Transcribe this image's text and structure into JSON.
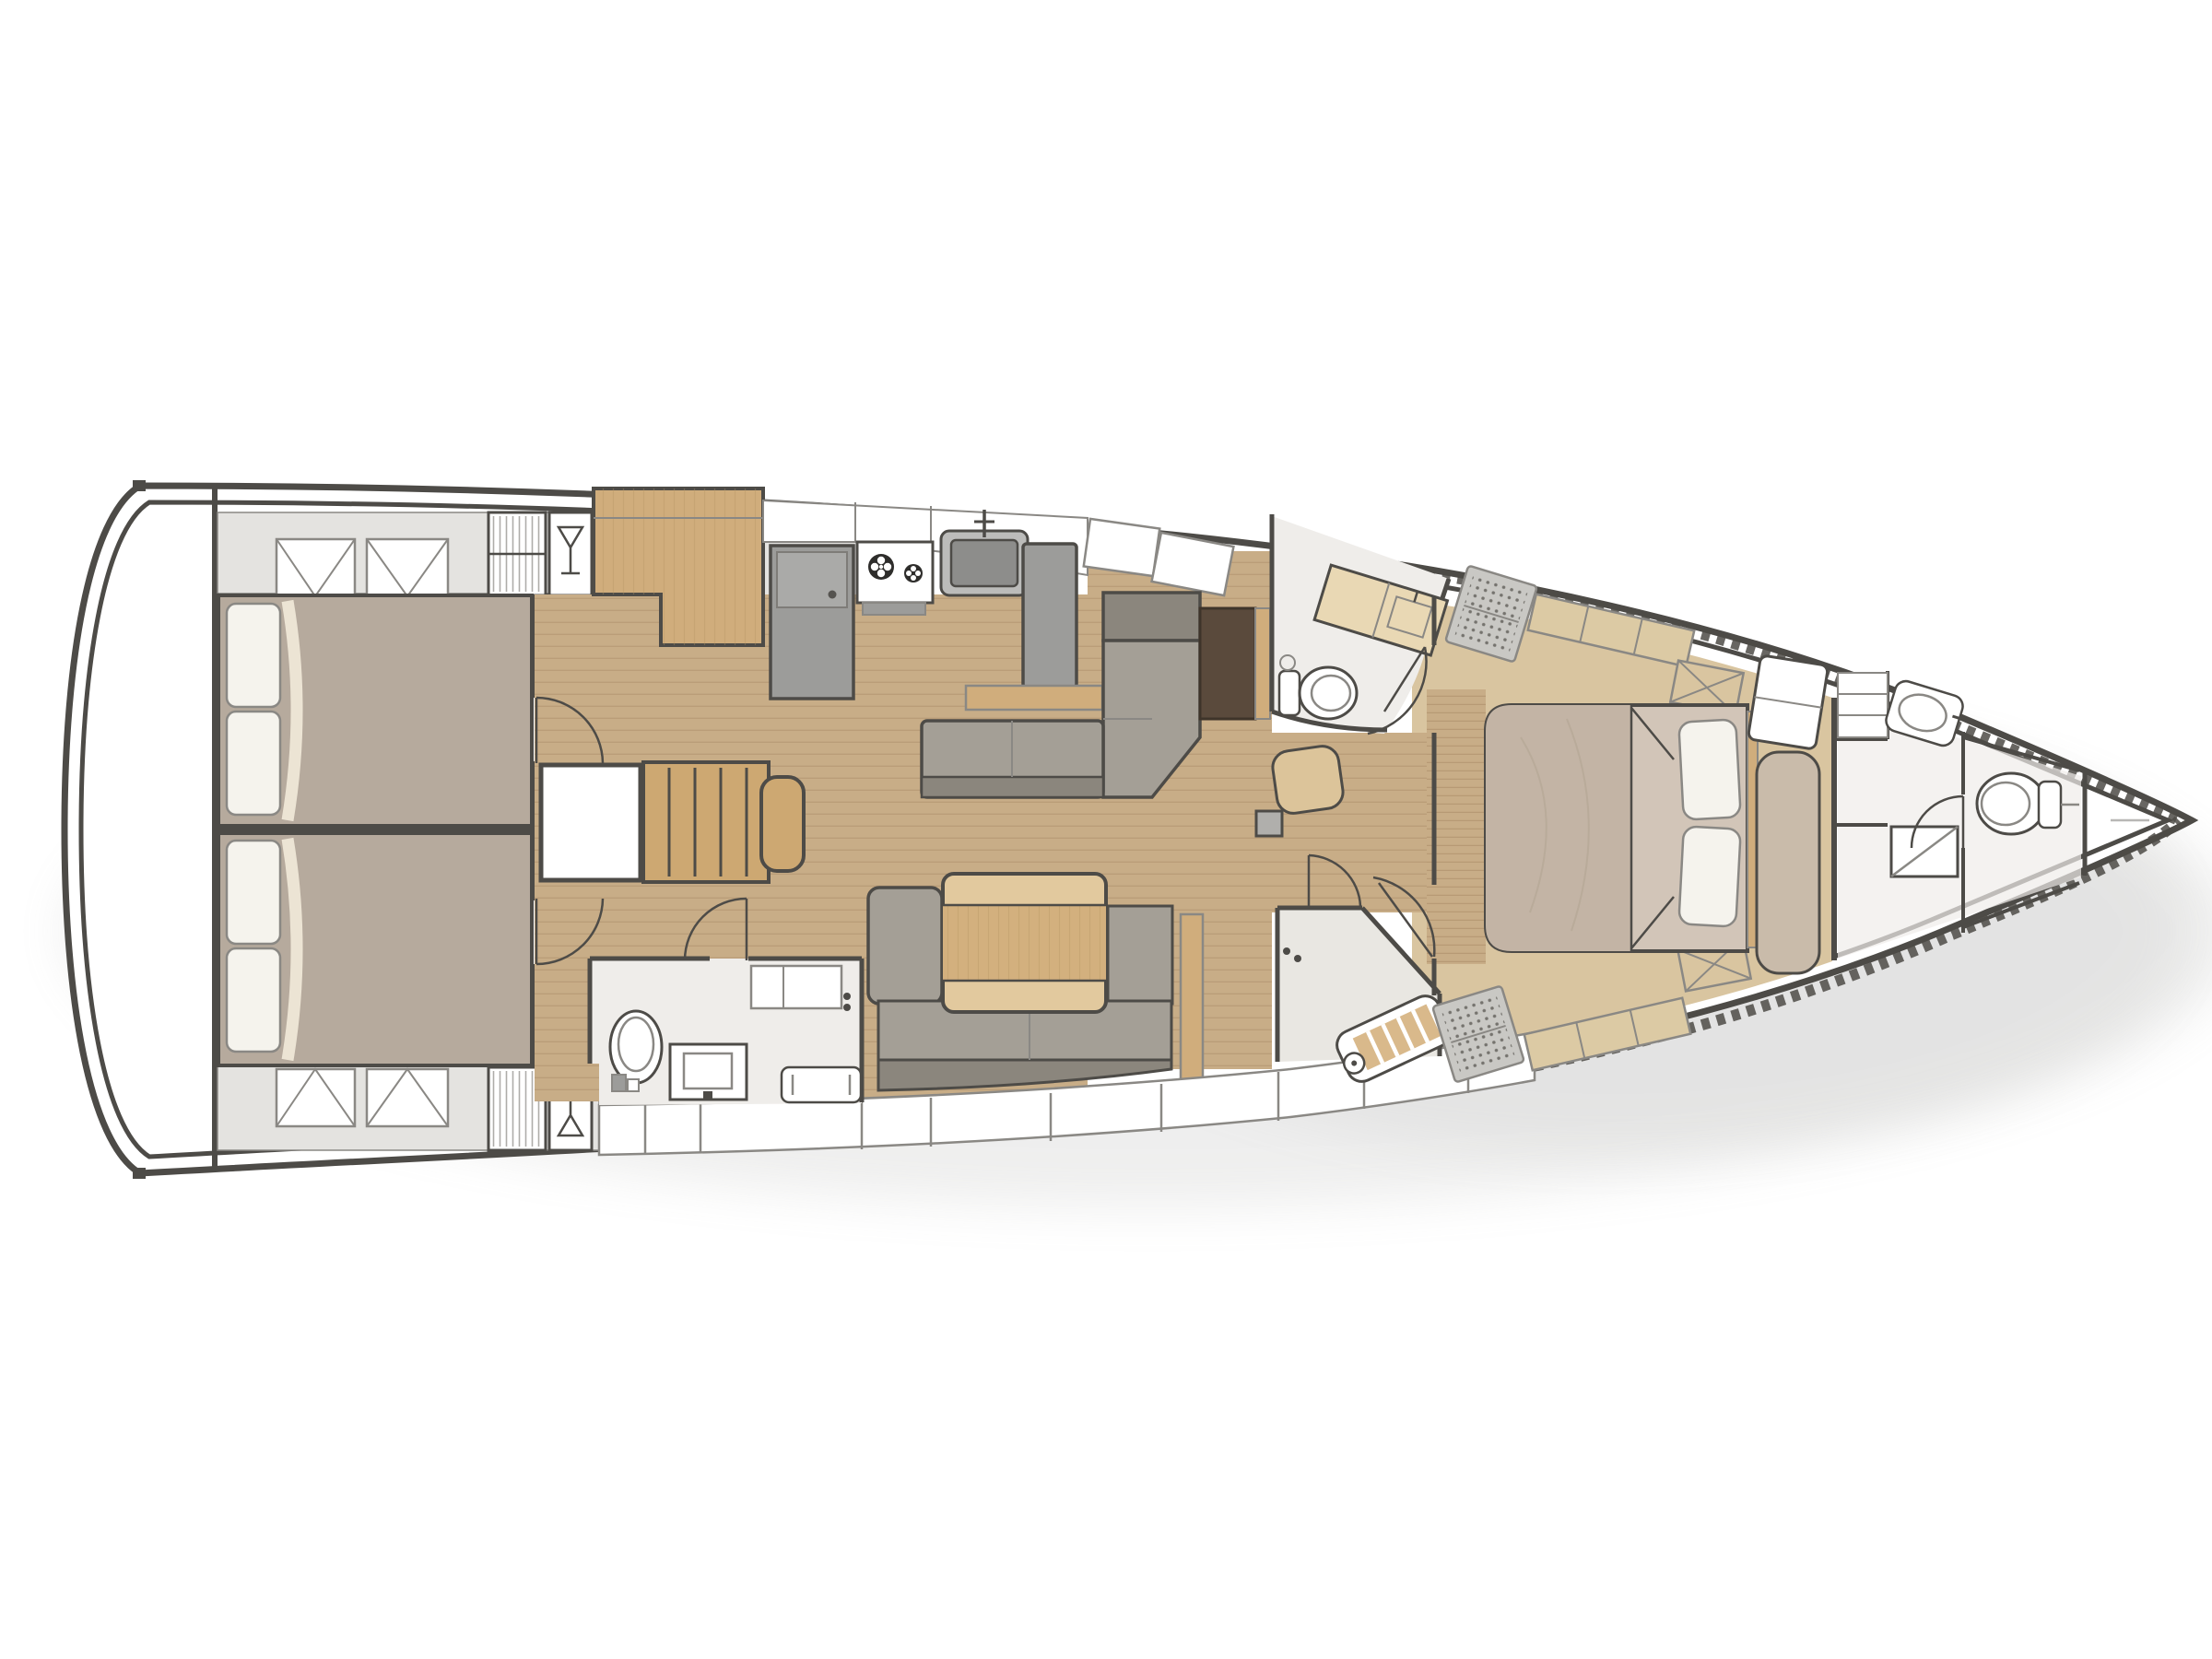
{
  "diagram": {
    "type": "yacht-interior-floor-plan",
    "view": "top-down",
    "bow_direction": "right",
    "rooms": [
      {
        "id": "transom-platform",
        "fixtures": []
      },
      {
        "id": "aft-cabin-starboard",
        "fixtures": [
          "double-berth",
          "pillows",
          "deck-hatch",
          "deck-hatch",
          "wardrobe-locker",
          "glass-locker"
        ]
      },
      {
        "id": "aft-cabin-port",
        "fixtures": [
          "double-berth",
          "pillows",
          "deck-hatch",
          "deck-hatch",
          "wardrobe-locker",
          "glass-locker"
        ]
      },
      {
        "id": "companionway",
        "fixtures": [
          "stairs",
          "engine-compartment"
        ]
      },
      {
        "id": "galley",
        "fixtures": [
          "tall-cabinet",
          "refrigerator",
          "two-burner-stove",
          "sink",
          "counter",
          "peninsula-counter"
        ]
      },
      {
        "id": "salon-starboard",
        "fixtures": [
          "l-shaped-settee",
          "chart-table",
          "nav-seat",
          "hull-lockers"
        ]
      },
      {
        "id": "salon-port",
        "fixtures": [
          "sofa",
          "folding-table",
          "hull-lockers"
        ]
      },
      {
        "id": "aft-head-port",
        "fixtures": [
          "toilet",
          "washbasin",
          "shower-bench",
          "wall-cabinet"
        ]
      },
      {
        "id": "mid-head-starboard",
        "fixtures": [
          "toilet",
          "vanity-counter",
          "door"
        ]
      },
      {
        "id": "mid-shower-port",
        "fixtures": [
          "teak-shower-bench",
          "louvered-grate",
          "door"
        ]
      },
      {
        "id": "owners-cabin-forward",
        "fixtures": [
          "island-double-berth",
          "pillows",
          "bench-seat",
          "dresser",
          "hull-shelf",
          "hull-shelf",
          "louvered-grate",
          "louvered-grate",
          "deck-hatch",
          "deck-hatch",
          "teak-sole"
        ]
      },
      {
        "id": "bow-head",
        "fixtures": [
          "toilet",
          "corner-washbasin",
          "shower-tray",
          "shelves"
        ]
      },
      {
        "id": "anchor-locker",
        "fixtures": []
      }
    ],
    "structure": [
      "hull-outline",
      "inner-liner",
      "bow-rubrail-chequer",
      "mast-step",
      "door-swings"
    ]
  },
  "colors": {
    "line-dark": "#4d4b47",
    "line-mid": "#8a8884",
    "line-soft": "#bdbbb6",
    "hull": "#ffffff",
    "deck-gray": "#e4e3e0",
    "room": "#efedea",
    "room2": "#e9e7e2",
    "wood-floor": "#c8ad87",
    "plank": "#ab8e69",
    "cabinet": "#d0ad7c",
    "stairs": "#cda872",
    "bed-taupe": "#b6aa9d",
    "sheet-cream": "#ece4d4",
    "pillow": "#f5f3ed",
    "master-bed": "#d2c5b8",
    "blanket": "#c3b4a5",
    "platform": "#d9c5a0",
    "sofa": "#a49f96",
    "sofa-dark": "#8b867d",
    "table-wood": "#d3b07e",
    "table-light": "#e2c99e",
    "gray-app": "#9c9c9a",
    "sink-gray": "#8d8d8b",
    "chart-brown": "#5a4a3c",
    "cream": "#e9d8b4",
    "grate": "#c9c8c4",
    "tan-seat": "#dcc49a",
    "shadow": "#9b9b98"
  }
}
